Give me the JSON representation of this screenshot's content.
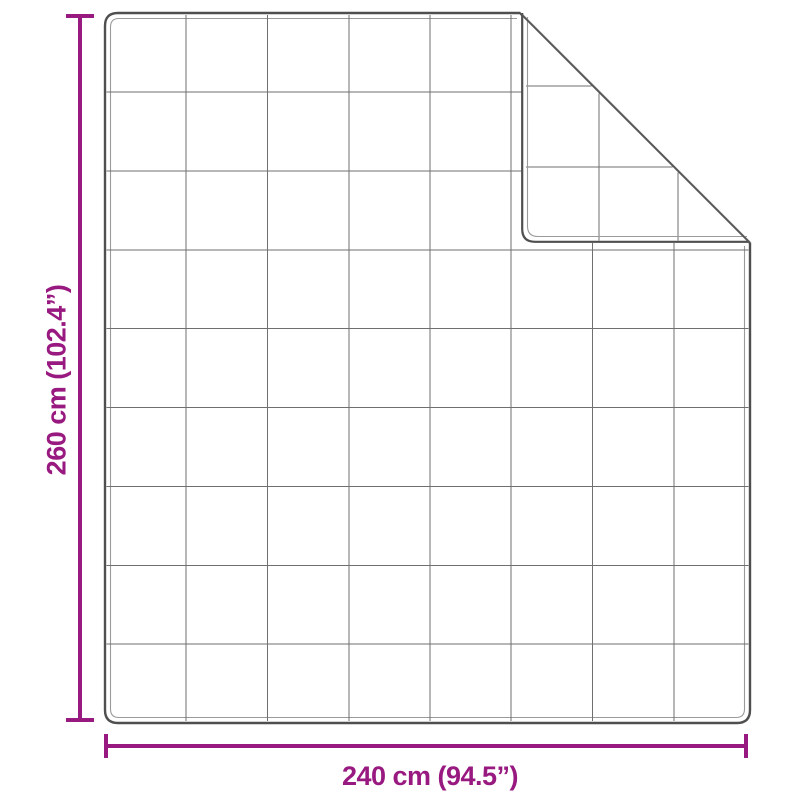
{
  "diagram": {
    "type": "product-dimension-diagram",
    "subject": "quilted blanket with folded top-right corner",
    "quilt_grid": {
      "columns": 8,
      "rows": 9
    },
    "dimensions": {
      "height": {
        "label": "260 cm (102.4”)",
        "value_cm": 260,
        "value_in": 102.4
      },
      "width": {
        "label": "240 cm (94.5”)",
        "value_cm": 240,
        "value_in": 94.5
      }
    },
    "colors": {
      "accent": "#98197f",
      "outline": "#4f4f4f",
      "grid": "#6f6f6f",
      "inner_line": "#9a9a9a",
      "background": "#ffffff"
    }
  }
}
